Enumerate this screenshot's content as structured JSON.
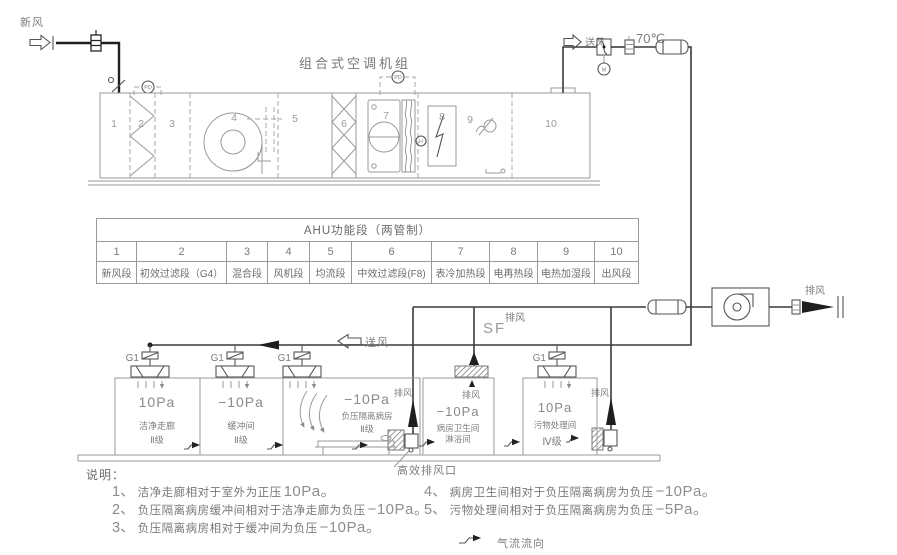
{
  "colors": {
    "background": "#ffffff",
    "line_gray": "#9a9a9a",
    "line_dark": "#1f1f1f",
    "text_gray": "#7d7d7d"
  },
  "ahu": {
    "title": "组合式空调机组",
    "fresh_air_label": "新风",
    "supply_air_label": "送风",
    "temperature_label": "70℃",
    "sensors": {
      "pd": "PD",
      "m": "M",
      "h": "H"
    }
  },
  "sections": {
    "table_title": "AHU功能段（两管制）",
    "items": [
      {
        "num": "1",
        "name": "新风段"
      },
      {
        "num": "2",
        "name": "初效过滤段（G4）"
      },
      {
        "num": "3",
        "name": "混合段"
      },
      {
        "num": "4",
        "name": "风机段"
      },
      {
        "num": "5",
        "name": "均流段"
      },
      {
        "num": "6",
        "name": "中效过滤段(F8)"
      },
      {
        "num": "7",
        "name": "表冷加热段"
      },
      {
        "num": "8",
        "name": "电再热段"
      },
      {
        "num": "9",
        "name": "电热加湿段"
      },
      {
        "num": "10",
        "name": "出风段"
      }
    ]
  },
  "plan": {
    "supply_fan_label": "SF",
    "supply_air_label": "送风",
    "exhaust_label": "排风",
    "diffuser_label": "G1",
    "hepa_outlet_label": "高效排风口",
    "rooms": [
      {
        "pressure": "10Pa",
        "name": "洁净走廊",
        "grade": "Ⅱ级"
      },
      {
        "pressure": "−10Pa",
        "name": "缓冲间",
        "grade": "Ⅱ级"
      },
      {
        "pressure": "−10Pa",
        "name": "负压隔离病房",
        "grade": "Ⅱ级"
      },
      {
        "pressure": "−10Pa",
        "name": "病房卫生间",
        "subname": "淋浴间"
      },
      {
        "pressure": "10Pa",
        "name": "污物处理间",
        "grade": "Ⅳ级"
      }
    ]
  },
  "notes": {
    "title": "说明：",
    "items": [
      {
        "num": "1、",
        "text": "洁净走廊相对于室外为正压",
        "value": "10Pa。"
      },
      {
        "num": "2、",
        "text": "负压隔离病房缓冲间相对于洁净走廊为负压",
        "value": "−10Pa。"
      },
      {
        "num": "3、",
        "text": "负压隔离病房相对于缓冲间为负压",
        "value": "−10Pa。"
      },
      {
        "num": "4、",
        "text": "病房卫生间相对于负压隔离病房为负压",
        "value": "−10Pa。"
      },
      {
        "num": "5、",
        "text": "污物处理间相对于负压隔离病房为负压",
        "value": "−5Pa。"
      }
    ],
    "legend_label": "气流流向"
  },
  "icons": {
    "fresh-air-arrow-icon": "hollow block arrow right",
    "supply-air-arrow-icon": "hollow block arrow left",
    "exhaust-arrow-icon": "solid black arrow right",
    "airflow-direction-icon": "small jog arrow right",
    "fan-icon": "centrifugal fan circle",
    "filter-icon": "zigzag lattice",
    "fire-damper-icon": "small hatched damper",
    "silencer-icon": "rounded capsule",
    "hepa-filter-icon": "diagonal hatched box",
    "diffuser-icon": "ceiling supply diffuser",
    "pressure-sensor-icon": "dashed PD circle",
    "motor-icon": "M circle",
    "humidity-sensor-icon": "H circle"
  }
}
